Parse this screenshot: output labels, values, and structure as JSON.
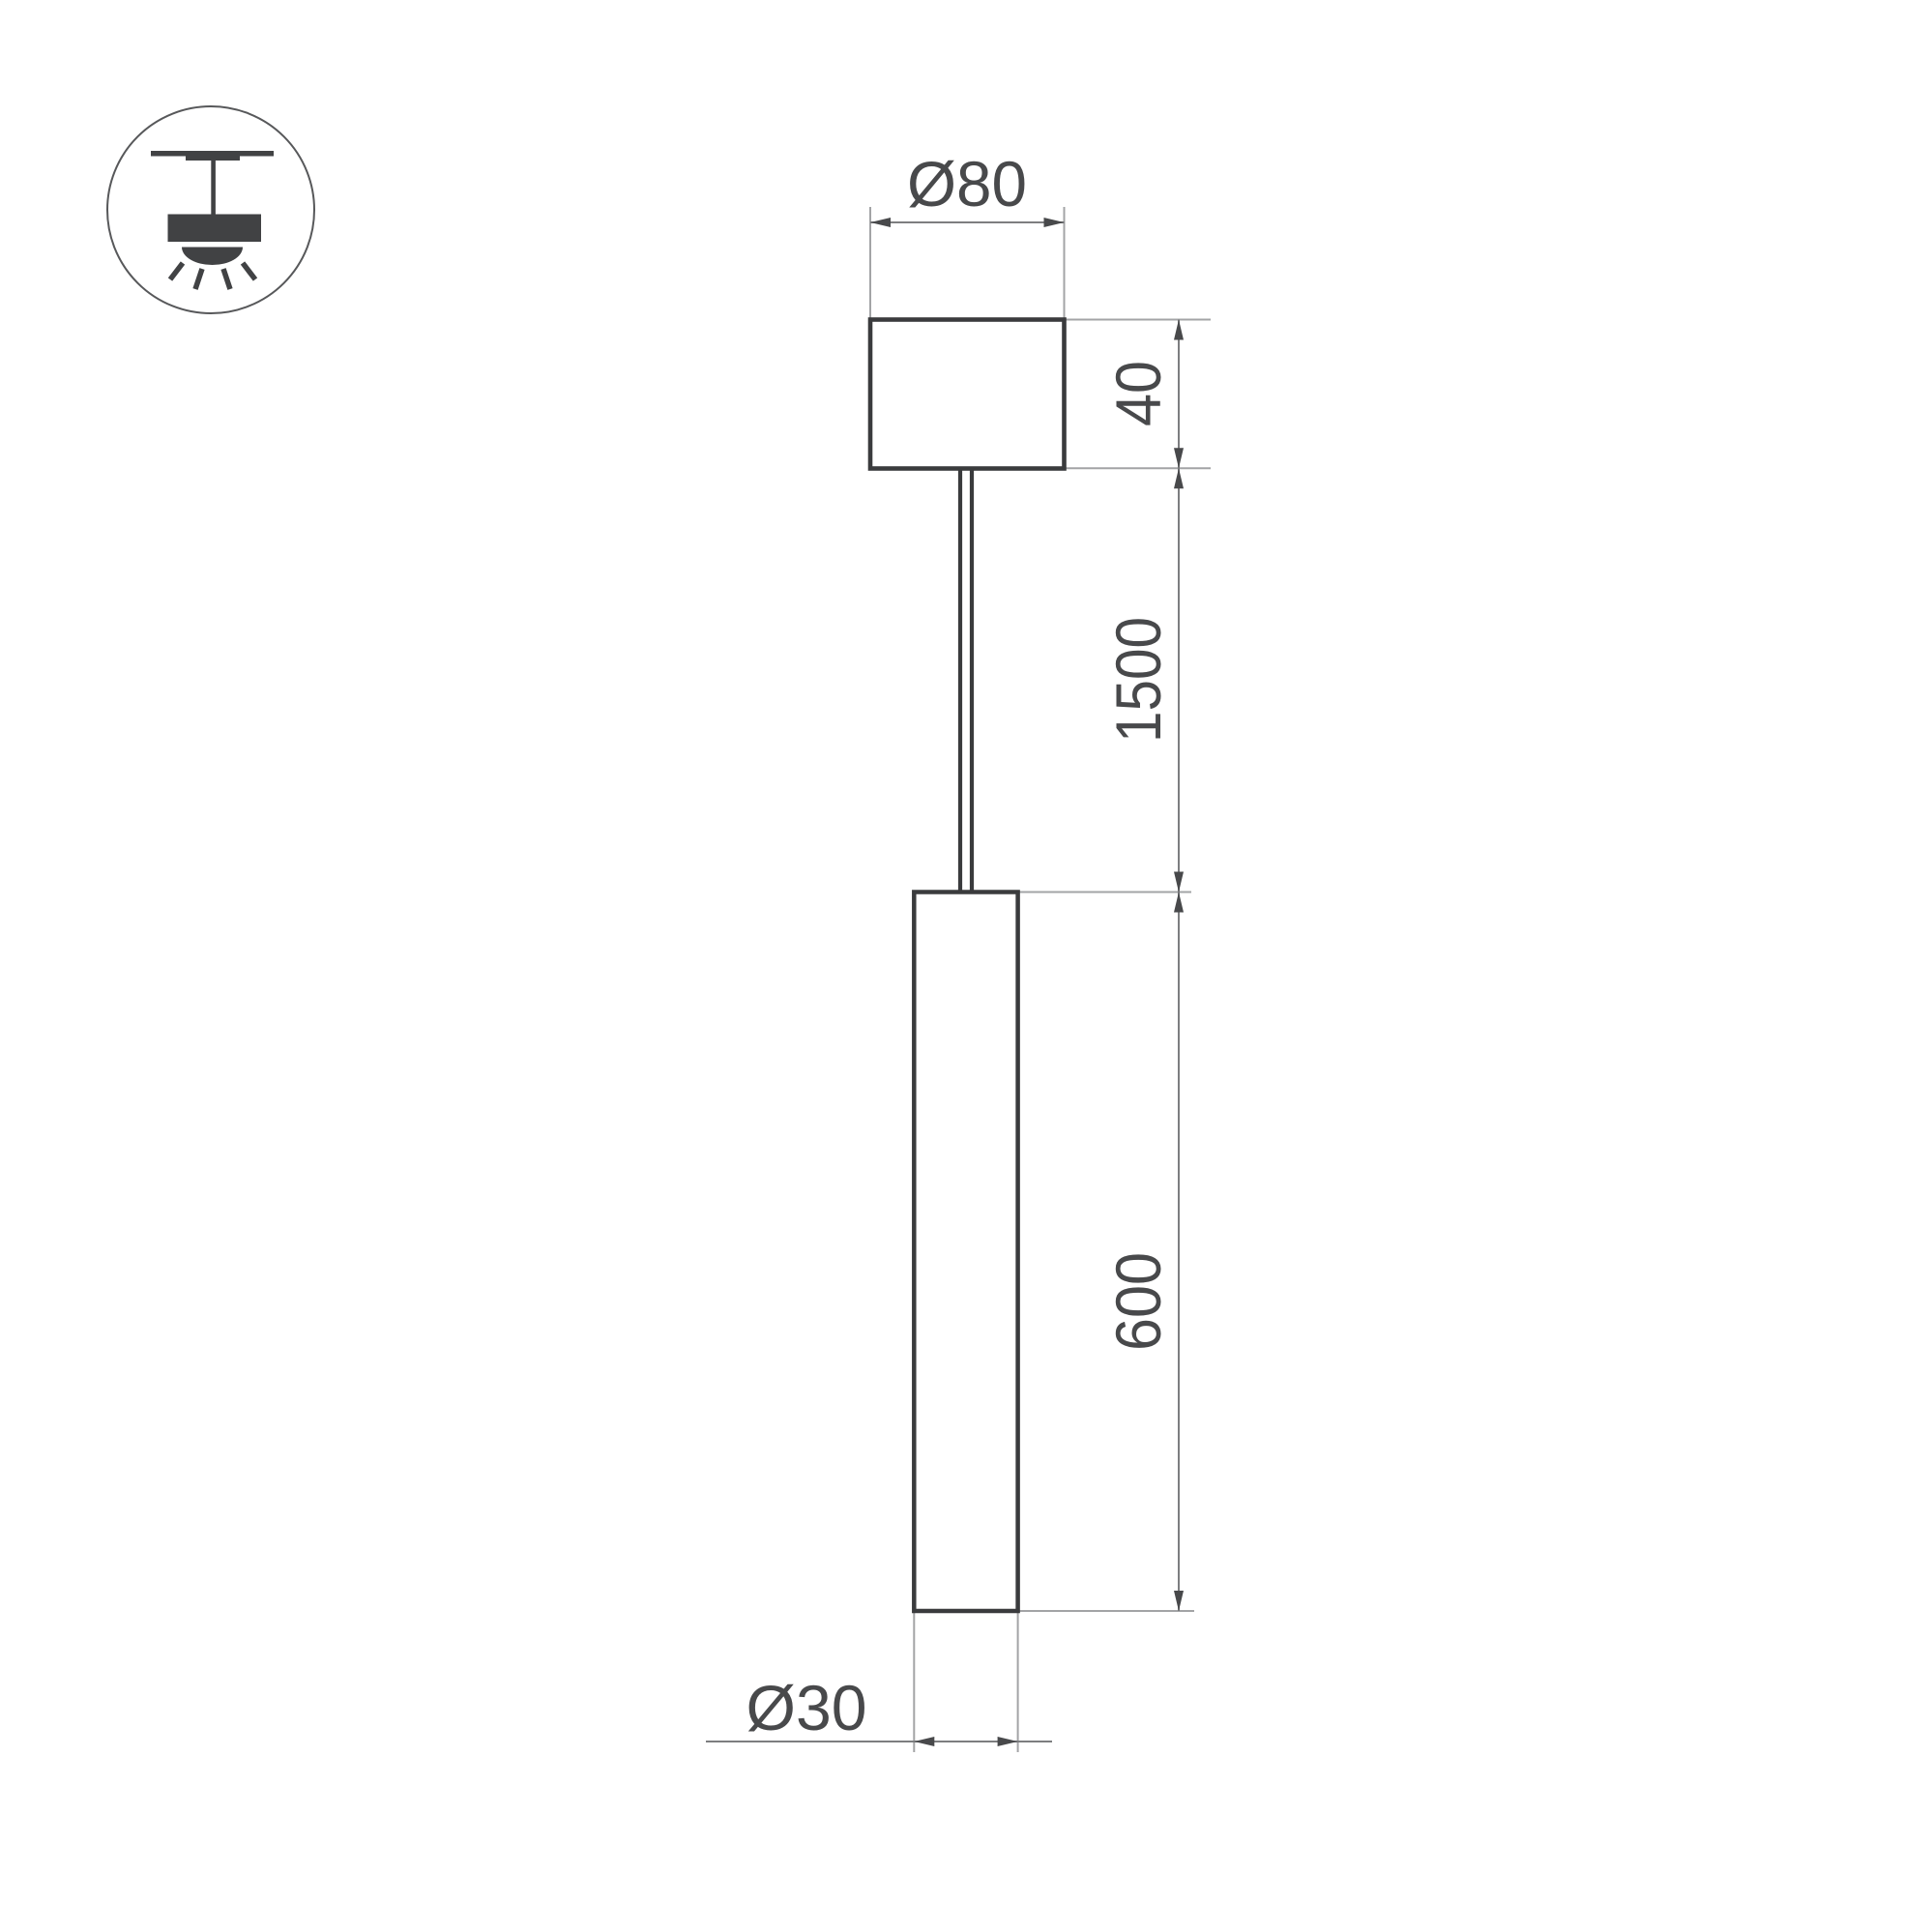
{
  "drawing": {
    "title": "pendant-luminaire-dimension-drawing",
    "dimensions": {
      "canopy_diameter": "Ø80",
      "canopy_height": "40",
      "suspension_length": "1500",
      "tube_length": "600",
      "tube_diameter": "Ø30"
    }
  },
  "icons": {
    "pendant_mount": "pendant-ceiling-light-icon"
  },
  "colors": {
    "background": "#ffffff",
    "object_line": "#3a3b3d",
    "dimension_line": "#7d7e80",
    "extension_line": "#a3a4a6",
    "arrow": "#48494b",
    "text": "#48494b",
    "icon_fill": "#414244",
    "icon_circle": "#57585a"
  }
}
